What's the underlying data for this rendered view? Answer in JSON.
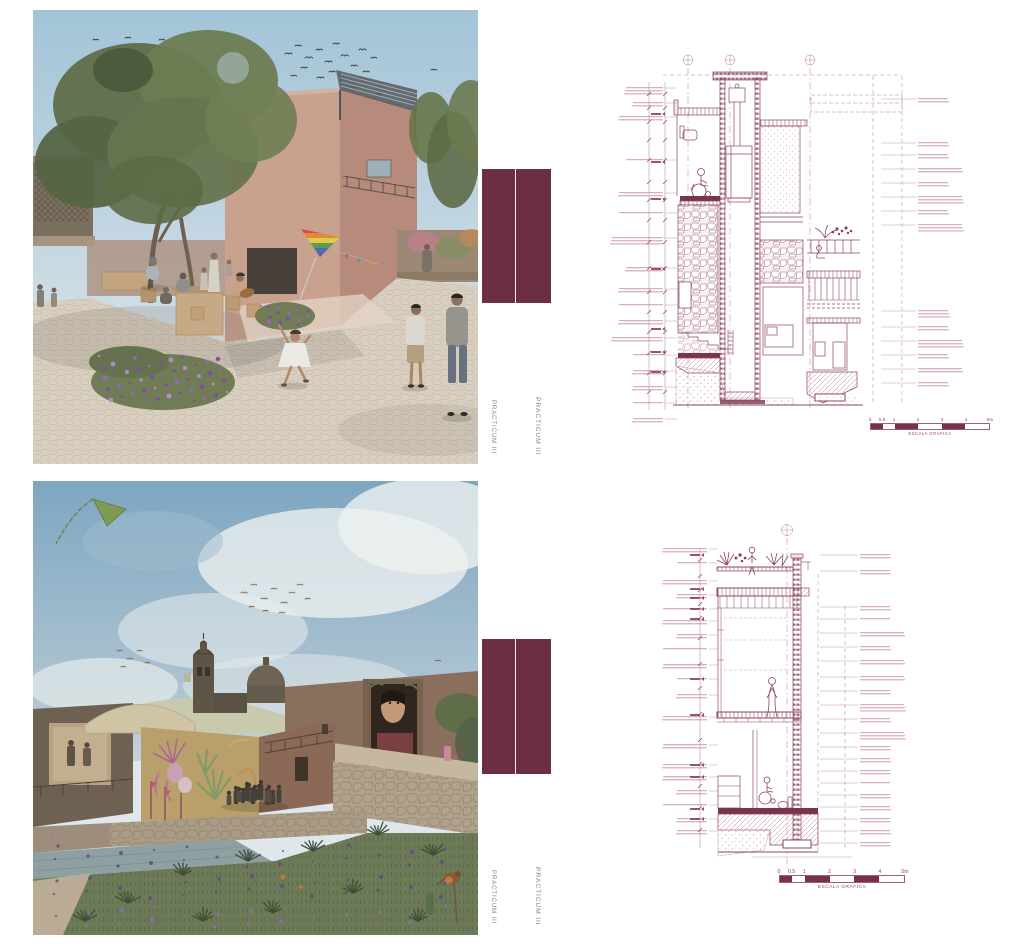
{
  "side_labels": {
    "top_left": "PRACTICUM III",
    "top_right": "PRACTICUM III",
    "bottom_left": "PRACTICUM III",
    "bottom_right": "PRACTICUM III"
  },
  "scale_bars": {
    "top": {
      "ticks": [
        "0",
        "0.5",
        "1",
        "2",
        "3",
        "4",
        "5m"
      ],
      "caption": "ESCALA GRAFICA"
    },
    "bottom": {
      "ticks": [
        "0",
        "0.5",
        "1",
        "2",
        "3",
        "4",
        "5m"
      ],
      "caption": "ESCALA GRAFICA"
    }
  },
  "colors": {
    "panel_maroon": "#6c2e45",
    "drawing_ink": "#8d4560",
    "drawing_ink_light": "#b87f92",
    "annotation_ink": "#d8afbc",
    "label_gray": "#8b8278"
  }
}
